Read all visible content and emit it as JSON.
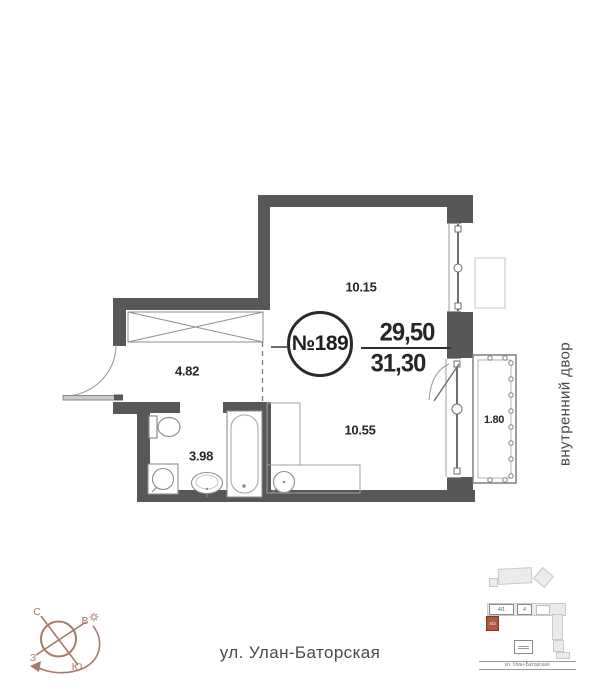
{
  "apartment": {
    "number": "№189",
    "area_top": "29,50",
    "area_bottom": "31,30"
  },
  "areas": {
    "upper_room": "10.15",
    "hallway": "4.82",
    "bathroom": "3.98",
    "lower_room": "10.55",
    "balcony": "1.80"
  },
  "labels": {
    "courtyard": "внутренний двор",
    "street": "ул. Улан-Баторская"
  },
  "compass": {
    "north": "С",
    "east": "В",
    "south": "Ю",
    "west": "З"
  },
  "minimap": {
    "building_1": "4/1",
    "building_2": "4",
    "highlighted_building": "4/3",
    "street": "ул. Улан-Баторская"
  },
  "colors": {
    "wall": "#565759",
    "compass": "#a87a6a",
    "highlight": "#b3543c"
  }
}
